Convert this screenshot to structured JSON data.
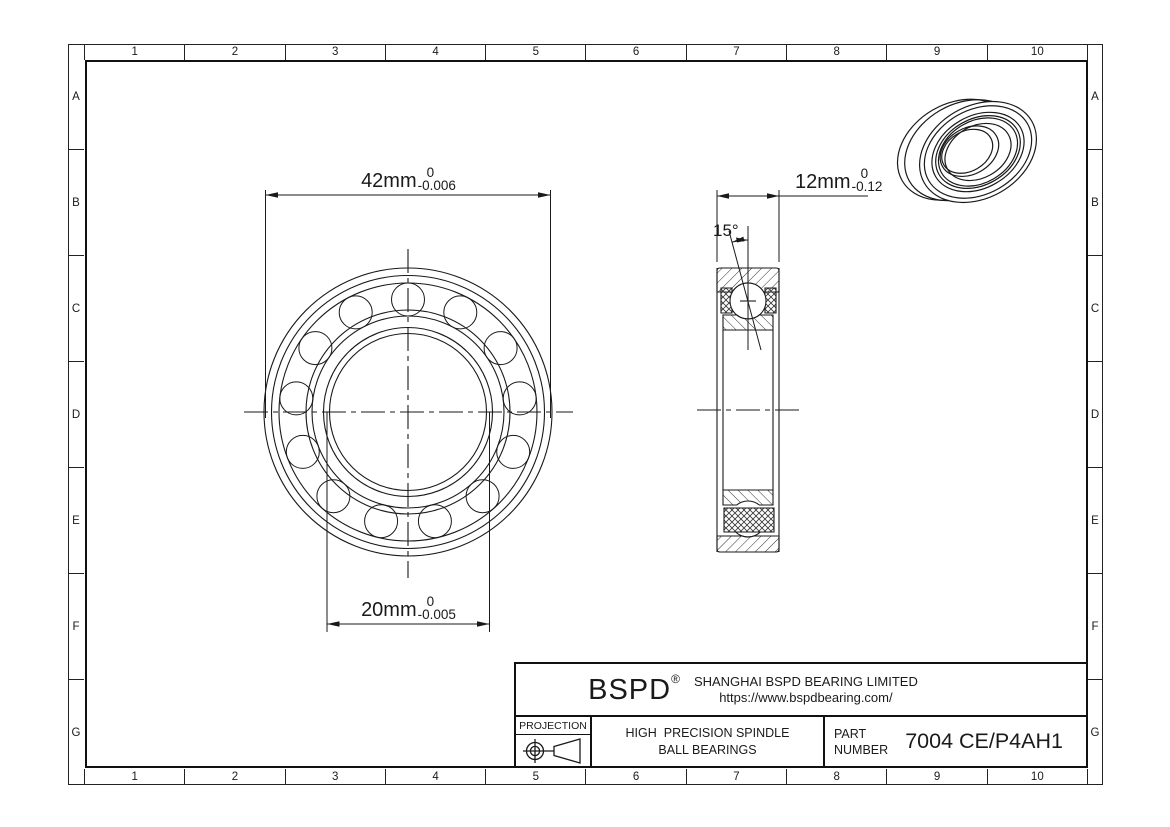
{
  "sheet": {
    "bg": "#ffffff",
    "line_color": "#1a1a1a"
  },
  "grid": {
    "cols": [
      "1",
      "2",
      "3",
      "4",
      "5",
      "6",
      "7",
      "8",
      "9",
      "10"
    ],
    "rows": [
      "A",
      "B",
      "C",
      "D",
      "E",
      "F",
      "G"
    ]
  },
  "dimensions": {
    "outer_diameter": {
      "value": "42mm",
      "tol_upper": "0",
      "tol_lower": "-0.006"
    },
    "bore_diameter": {
      "value": "20mm",
      "tol_upper": "0",
      "tol_lower": "-0.005"
    },
    "width": {
      "value": "12mm",
      "tol_upper": "0",
      "tol_lower": "-0.12"
    },
    "contact_angle": "15°"
  },
  "title_block": {
    "logo": "BSPD",
    "logo_reg": "®",
    "company": "SHANGHAI BSPD BEARING LIMITED",
    "website": "https://www.bspdbearing.com/",
    "projection_label": "PROJECTION",
    "product_line1": "HIGH  PRECISION SPINDLE",
    "product_line2": "BALL BEARINGS",
    "part_label_line1": "PART",
    "part_label_line2": "NUMBER",
    "part_number": "7004 CE/P4AH1"
  }
}
